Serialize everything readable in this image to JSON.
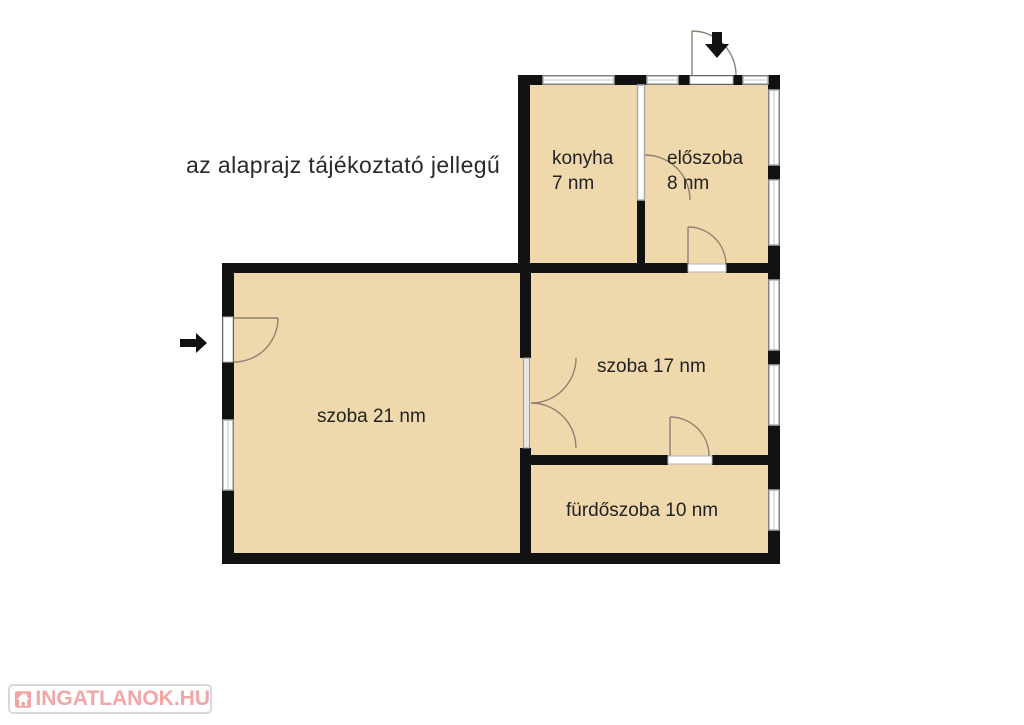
{
  "disclaimer": "az alaprajz tájékoztató jellegű",
  "rooms": {
    "konyha": {
      "name": "konyha",
      "area": "7 nm"
    },
    "eloszoba": {
      "name": "előszoba",
      "area": "8 nm"
    },
    "szoba17": {
      "label": "szoba 17 nm"
    },
    "szoba21": {
      "label": "szoba 21 nm"
    },
    "furdoszoba": {
      "label": "fürdőszoba 10 nm"
    }
  },
  "watermark": {
    "text": "INGATLANOK.HU"
  },
  "icons": {
    "entrance_arrow_left": "arrow-right",
    "entrance_arrow_top": "arrow-down",
    "logo_house": "house"
  },
  "colors": {
    "floor": "#f0d8ad",
    "wall": "#111111",
    "window_frame": "#aaaaaa",
    "door_arc": "#8d8272",
    "text": "#222222",
    "logo_pink": "#f2a6a6",
    "logo_border": "#d8d8d8"
  }
}
